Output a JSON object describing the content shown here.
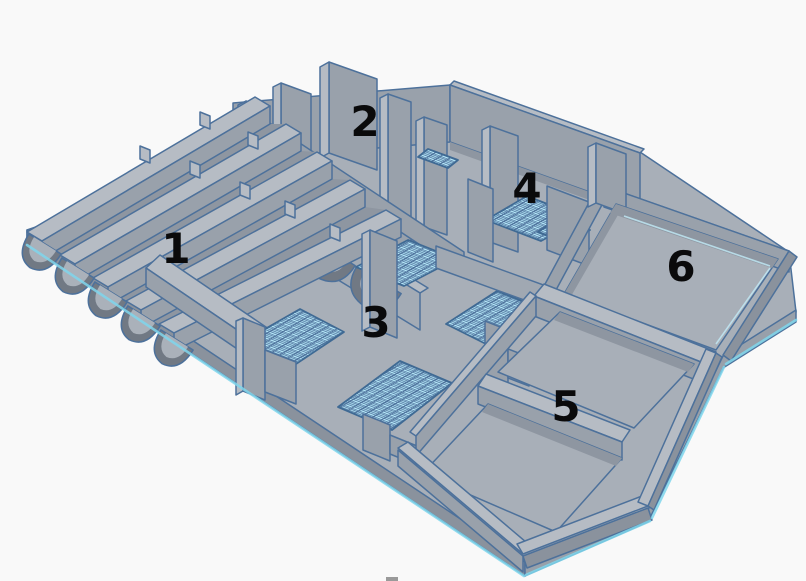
{
  "viewport": {
    "background": "#f9f9f9"
  },
  "model": {
    "section_labels": [
      {
        "text": "1"
      },
      {
        "text": "2"
      },
      {
        "text": "3"
      },
      {
        "text": "4"
      },
      {
        "text": "5"
      },
      {
        "text": "6"
      }
    ]
  },
  "palette": {
    "background": "#f9f9f9",
    "wall_top": "#b6bcc4",
    "wall_front": "#99a1ab",
    "wall_side": "#8a929d",
    "floor": "#a8afb8",
    "deep_shadow": "#717984",
    "outline": "#4d719b",
    "grid_fill": "#b5e7f8",
    "grid_line": "#7cc8e2",
    "edge_glow": "#7fd6ec",
    "label_color": "#0a0a0b",
    "artifact_gray": "#9a9a9a"
  }
}
